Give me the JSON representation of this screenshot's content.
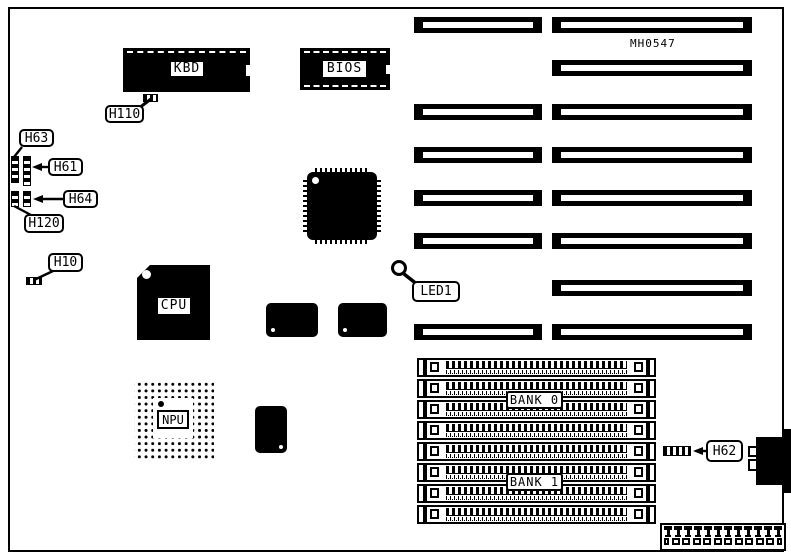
{
  "diagram": {
    "part_number": "MH0547",
    "ink_color": "#000000",
    "paper_color": "#ffffff"
  },
  "chips": {
    "kbd": {
      "label": "KBD"
    },
    "bios": {
      "label": "BIOS"
    },
    "cpu": {
      "label": "CPU"
    },
    "npu": {
      "label": "NPU"
    }
  },
  "callouts": {
    "h63": {
      "label": "H63"
    },
    "h61": {
      "label": "H61"
    },
    "h64": {
      "label": "H64"
    },
    "h120": {
      "label": "H120"
    },
    "h10": {
      "label": "H10"
    },
    "h110": {
      "label": "H110"
    },
    "led1": {
      "label": "LED1"
    },
    "h62": {
      "label": "H62"
    }
  },
  "memory": {
    "bank0_label": "BANK 0",
    "bank1_label": "BANK 1",
    "simm_slot_count": 8
  },
  "expansion": {
    "right_column_slot_count": 8,
    "left_column_slot_count": 6
  },
  "power_connector": {
    "pin_count": 12
  }
}
